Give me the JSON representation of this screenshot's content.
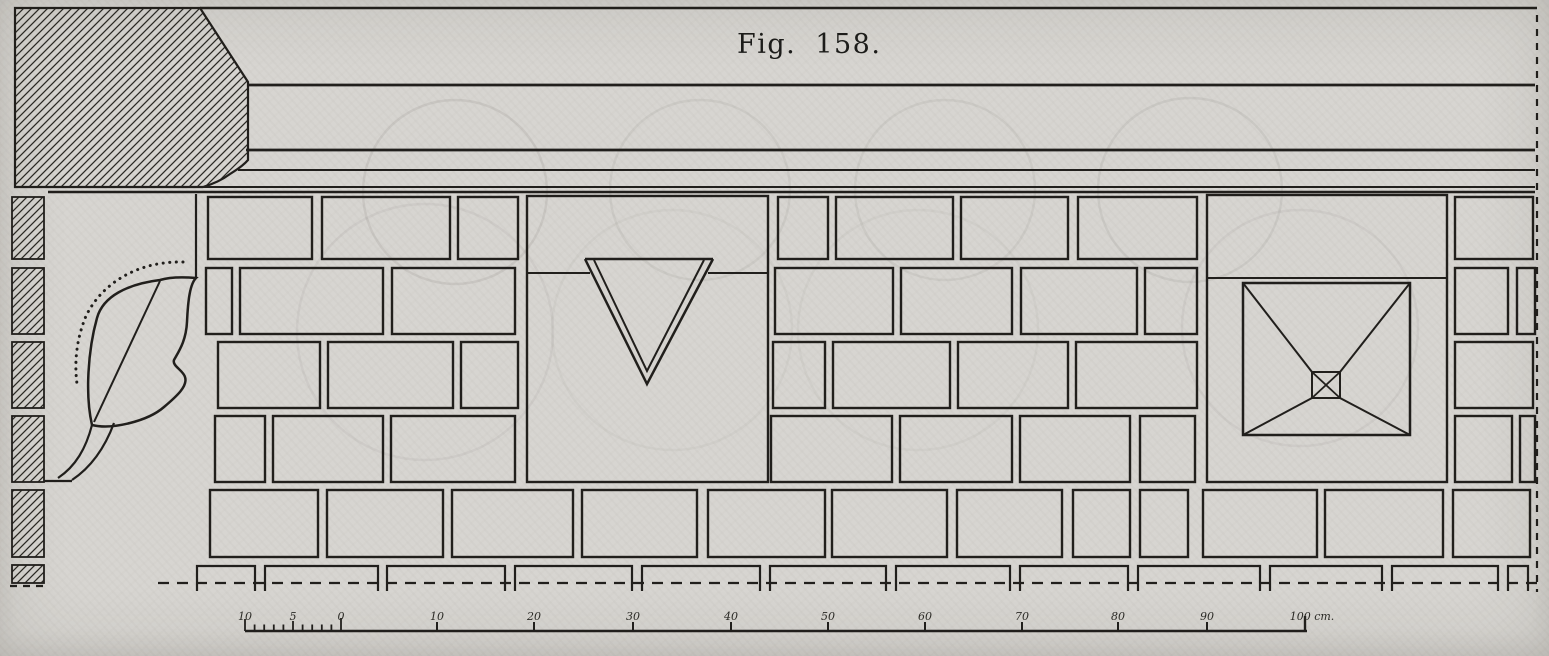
{
  "figure": {
    "label": "Fig. 158."
  },
  "palette": {
    "paper": "#d7d5d1",
    "ink": "#211f1c",
    "ghost": "#8f8e89"
  },
  "drawing": {
    "cornice_lines": [
      {
        "x1": 200,
        "y1": 8,
        "x2": 1537,
        "y2": 8,
        "w": 2.4
      },
      {
        "x1": 248,
        "y1": 85,
        "x2": 1535,
        "y2": 85,
        "w": 2.8
      },
      {
        "x1": 246,
        "y1": 150,
        "x2": 1535,
        "y2": 150,
        "w": 2.8
      },
      {
        "x1": 238,
        "y1": 170,
        "x2": 1535,
        "y2": 170,
        "w": 2.1
      },
      {
        "x1": 48,
        "y1": 187,
        "x2": 1535,
        "y2": 187,
        "w": 2.1
      },
      {
        "x1": 48,
        "y1": 192,
        "x2": 1535,
        "y2": 192,
        "w": 2.4
      }
    ],
    "corner_block_path": "M15,8 L200,8 L248,82 L248,160 C242,167 236,170 230,174 C222,180 213,184 203,187 L15,187 Z",
    "section_strip": {
      "x1": 12,
      "x2": 44,
      "segments": [
        [
          197,
          259
        ],
        [
          268,
          334
        ],
        [
          342,
          408
        ],
        [
          416,
          482
        ],
        [
          490,
          557
        ],
        [
          565,
          583
        ]
      ]
    },
    "courses": [
      {
        "y1": 197,
        "y2": 259,
        "blocks": [
          [
            208,
            312
          ],
          [
            322,
            450
          ],
          [
            458,
            518
          ],
          [
            778,
            828
          ],
          [
            836,
            953
          ],
          [
            961,
            1068
          ],
          [
            1078,
            1197
          ],
          [
            1455,
            1533
          ]
        ]
      },
      {
        "y1": 268,
        "y2": 334,
        "blocks": [
          [
            206,
            232
          ],
          [
            240,
            383
          ],
          [
            392,
            515
          ],
          [
            775,
            893
          ],
          [
            901,
            1012
          ],
          [
            1021,
            1137
          ],
          [
            1145,
            1197
          ],
          [
            1455,
            1508
          ],
          [
            1517,
            1535
          ]
        ]
      },
      {
        "y1": 342,
        "y2": 408,
        "blocks": [
          [
            218,
            320
          ],
          [
            328,
            453
          ],
          [
            461,
            518
          ],
          [
            773,
            825
          ],
          [
            833,
            950
          ],
          [
            958,
            1068
          ],
          [
            1076,
            1197
          ],
          [
            1455,
            1533
          ]
        ]
      },
      {
        "y1": 416,
        "y2": 482,
        "blocks": [
          [
            215,
            265
          ],
          [
            273,
            383
          ],
          [
            391,
            515
          ],
          [
            771,
            892
          ],
          [
            900,
            1012
          ],
          [
            1020,
            1130
          ],
          [
            1140,
            1195
          ],
          [
            1455,
            1512
          ],
          [
            1520,
            1535
          ]
        ]
      },
      {
        "y1": 490,
        "y2": 557,
        "blocks": [
          [
            210,
            318
          ],
          [
            327,
            443
          ],
          [
            452,
            573
          ],
          [
            582,
            697
          ],
          [
            708,
            825
          ],
          [
            832,
            947
          ],
          [
            957,
            1062
          ],
          [
            1073,
            1130
          ],
          [
            1140,
            1188
          ],
          [
            1203,
            1317
          ],
          [
            1325,
            1443
          ],
          [
            1453,
            1530
          ]
        ]
      }
    ],
    "triangle_panel": {
      "x1": 527,
      "x2": 768,
      "y1": 196,
      "y2": 482,
      "joint_y": 273,
      "joint_gap": [
        590,
        708
      ],
      "top_line": {
        "x1": 585,
        "x2": 713,
        "y": 259
      },
      "outer_v": "585,259 647,384 713,259",
      "inner_v": "594,260 647,371 704,260"
    },
    "coffer_panel": {
      "x1": 1207,
      "x2": 1447,
      "y1": 195,
      "y2": 482,
      "joint_y": 278,
      "outer": {
        "x1": 1243,
        "y1": 283,
        "x2": 1410,
        "y2": 435
      },
      "inner": {
        "x1": 1312,
        "y1": 372,
        "x2": 1340,
        "y2": 398
      },
      "diagonals": [
        [
          1243,
          283,
          1312,
          372
        ],
        [
          1410,
          283,
          1340,
          372
        ],
        [
          1243,
          435,
          1312,
          398
        ],
        [
          1410,
          435,
          1340,
          398
        ]
      ],
      "inner_x": [
        [
          1312,
          372,
          1340,
          398
        ],
        [
          1340,
          372,
          1312,
          398
        ]
      ]
    },
    "console": {
      "corner_line": {
        "x1": 196,
        "y1": 194,
        "x2": 196,
        "y2": 277
      },
      "leaf_path": "M196,278 C184,277 170,277 160,280 C128,284 103,296 97,318 C88,350 85,395 92,425 C112,430 148,421 164,407 C177,396 188,386 185,377 C183,370 172,366 174,360 C179,351 186,341 187,322 C188,300 190,284 196,278 Z",
      "chord": {
        "x1": 160,
        "y1": 281,
        "x2": 94,
        "y2": 422
      },
      "dotted_path": "M183,262 C138,261 102,283 86,316 C77,338 74,360 77,384",
      "stem_outer": "M114,423 C104,450 90,468 72,480",
      "stem_inner": "M92,425 C86,448 76,466 58,478",
      "base_line": {
        "x1": 44,
        "y1": 481,
        "x2": 72,
        "y2": 481
      }
    },
    "plinth": {
      "top": 566,
      "bottom": 591,
      "blocks": [
        [
          197,
          255
        ],
        [
          265,
          378
        ],
        [
          387,
          505
        ],
        [
          515,
          632
        ],
        [
          642,
          760
        ],
        [
          770,
          886
        ],
        [
          896,
          1010
        ],
        [
          1020,
          1128
        ],
        [
          1138,
          1260
        ],
        [
          1270,
          1382
        ],
        [
          1392,
          1498
        ],
        [
          1508,
          1528
        ]
      ]
    },
    "ground_line": {
      "y": 583,
      "x1": 158,
      "x2": 1537,
      "left_piece": {
        "x1": 10,
        "x2": 46,
        "y": 586
      }
    },
    "right_edge": {
      "x": 1537,
      "y1": 15,
      "y2": 592
    },
    "ghost_arcs": [
      {
        "cx": 455,
        "cy": 192,
        "r": 92,
        "o": 0.2
      },
      {
        "cx": 700,
        "cy": 190,
        "r": 90,
        "o": 0.15
      },
      {
        "cx": 945,
        "cy": 190,
        "r": 90,
        "o": 0.15
      },
      {
        "cx": 1190,
        "cy": 190,
        "r": 92,
        "o": 0.18
      },
      {
        "cx": 425,
        "cy": 332,
        "r": 128,
        "o": 0.13
      },
      {
        "cx": 672,
        "cy": 330,
        "r": 120,
        "o": 0.09
      },
      {
        "cx": 918,
        "cy": 330,
        "r": 120,
        "o": 0.09
      },
      {
        "cx": 1300,
        "cy": 328,
        "r": 118,
        "o": 0.13
      }
    ],
    "scale_bar": {
      "bar_y": 631,
      "x_start": 245,
      "x_end": 1307,
      "left_section": {
        "start": 245,
        "step": 9.6,
        "divisions": 10
      },
      "major_ticks": [
        437,
        534,
        633,
        731,
        828,
        925,
        1022,
        1118,
        1207
      ],
      "end_tick": 1305,
      "labels": [
        {
          "t": "10",
          "x": 245
        },
        {
          "t": "5",
          "x": 293
        },
        {
          "t": "0",
          "x": 341
        },
        {
          "t": "10",
          "x": 437
        },
        {
          "t": "20",
          "x": 534
        },
        {
          "t": "30",
          "x": 633
        },
        {
          "t": "40",
          "x": 731
        },
        {
          "t": "50",
          "x": 828
        },
        {
          "t": "60",
          "x": 925
        },
        {
          "t": "70",
          "x": 1022
        },
        {
          "t": "80",
          "x": 1118
        },
        {
          "t": "90",
          "x": 1207
        },
        {
          "t": "100 cm.",
          "x": 1312
        }
      ]
    }
  }
}
